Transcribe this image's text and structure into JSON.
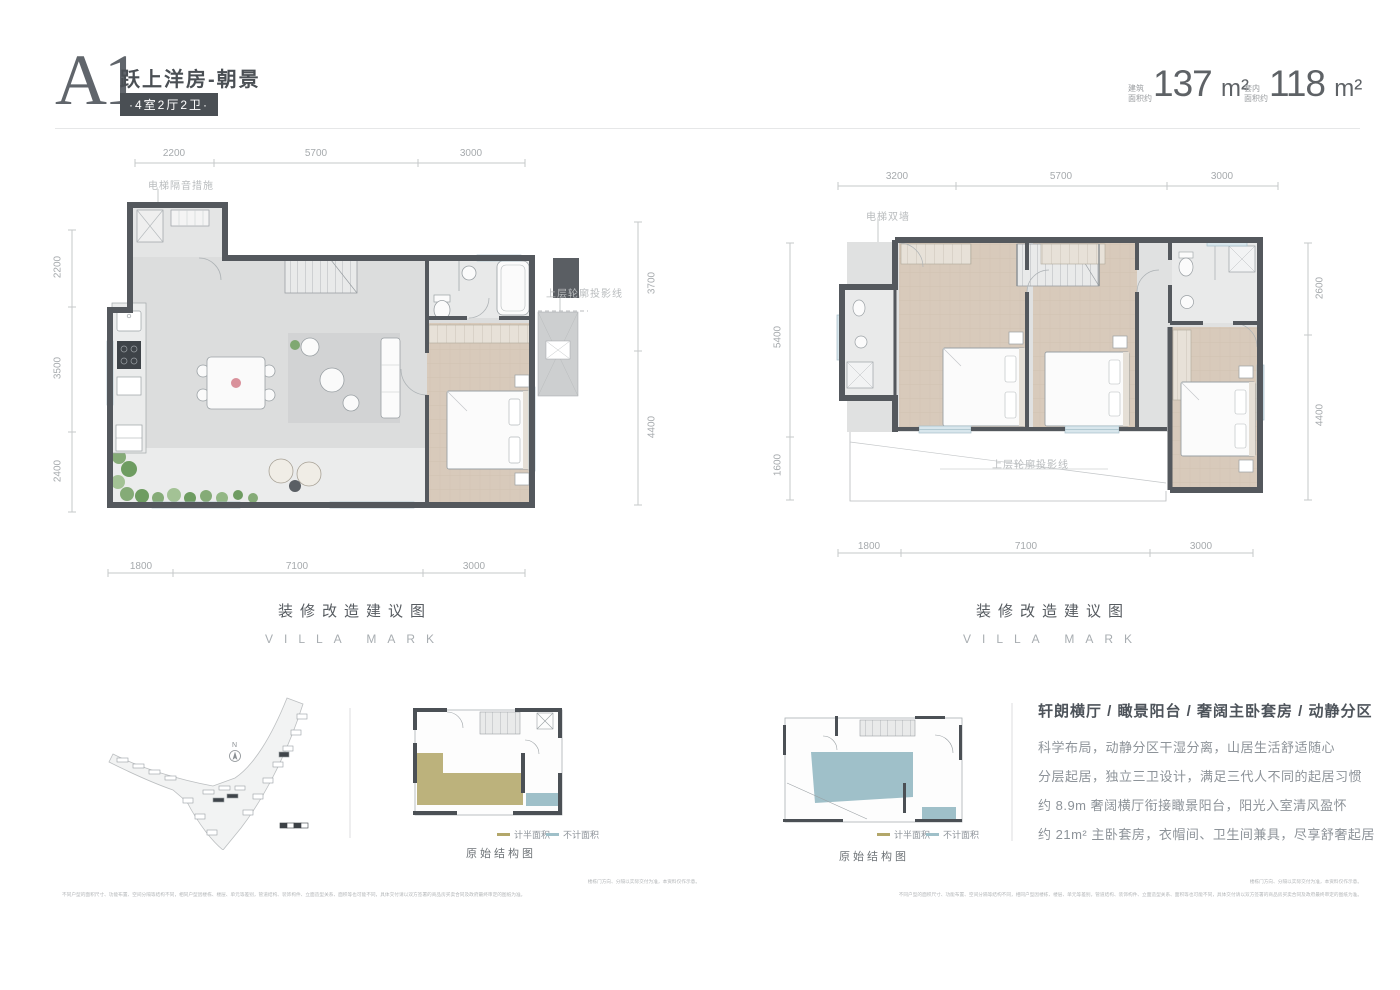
{
  "header": {
    "unit_code": "A1",
    "title": "跃上洋房-朝景",
    "badge": "·4室2厅2卫·",
    "areas": [
      {
        "label_line1": "建筑",
        "label_line2": "面积约",
        "value": "137",
        "unit": "m²"
      },
      {
        "label_line1": "套内",
        "label_line2": "面积约",
        "value": "118",
        "unit": "m²"
      }
    ]
  },
  "plan_left": {
    "dims_top": [
      "2200",
      "5700",
      "3000"
    ],
    "dims_left": [
      "2200",
      "3500",
      "2400"
    ],
    "dims_right": [
      "3700",
      "4400"
    ],
    "dims_bottom": [
      "1800",
      "7100",
      "3000"
    ],
    "note_elevator": "电梯隔音措施",
    "note_projection": "上层轮廓投影线",
    "caption": "装修改造建议图",
    "caption_en": "VILLA MARK"
  },
  "plan_right": {
    "dims_top": [
      "3200",
      "5700",
      "3000"
    ],
    "dims_left": [
      "5400",
      "1600"
    ],
    "dims_right": [
      "2600",
      "4400"
    ],
    "dims_bottom": [
      "1800",
      "7100",
      "3000"
    ],
    "note_elevator": "电梯双墙",
    "note_projection": "上层轮廓投影线",
    "caption": "装修改造建议图",
    "caption_en": "VILLA MARK"
  },
  "footer": {
    "north_label": "N",
    "legend": [
      {
        "label": "计半面积",
        "color": "#b3a76a"
      },
      {
        "label": "不计面积",
        "color": "#9fc0c9"
      }
    ],
    "structure_caption": "原始结构图",
    "description": {
      "title": "轩朗横厅 / 瞰景阳台 / 奢阔主卧套房 / 动静分区",
      "lines": [
        "科学布局，动静分区干湿分离，山居生活舒适随心",
        "分层起居，独立三卫设计，满足三代人不同的起居习惯",
        "约 8.9m 奢阔横厅衔接瞰景阳台，阳光入室清风盈怀",
        "约 21m² 主卧套房，衣帽间、卫生间兼具，尽享舒奢起居"
      ]
    },
    "disclaimer_line1": "楼栋门方向、分隔以实际交付为准，本资料仅作示意。",
    "disclaimer_line2": "不同户型的面积尺寸、功能布置、空间分隔等结构不同，相同户型因楼栋、楼层、单元等差别，管道结构、装饰构件、立面造型关系、面积等也可能不同，具体交付请以双方签署的商品房买卖合同及政府最终审定的图纸为准。"
  },
  "colors": {
    "wall": "#54585d",
    "wood_floor": "#d8cabb",
    "floor": "#dcdddd",
    "window": "#d8e6ec",
    "plant_green": "#85ab77",
    "legend_half": "#b3a76a",
    "legend_none": "#9fc0c9",
    "badge_bg": "#4a4f54"
  }
}
